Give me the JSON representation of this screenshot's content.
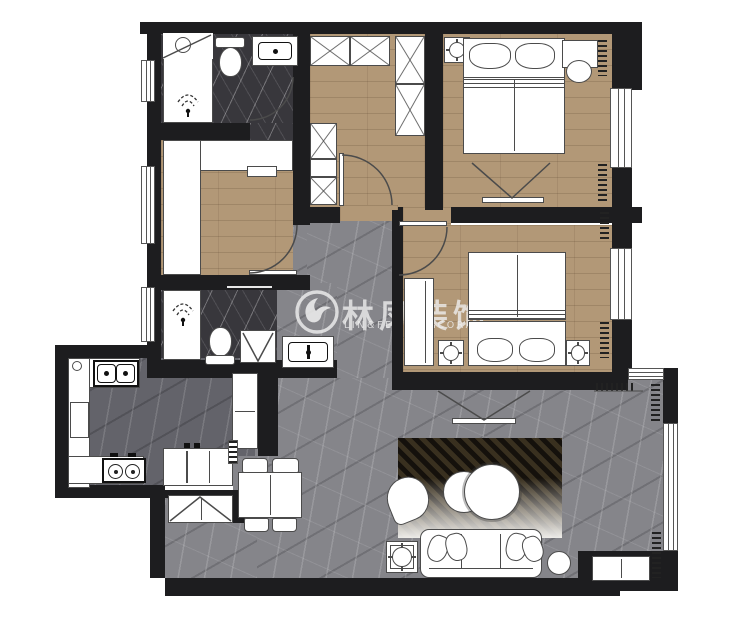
{
  "watermark": {
    "title": "林凤装饰",
    "subtitle": "LIN&FENG DECORATION",
    "logo": "phoenix-swirl-logo"
  },
  "palette": {
    "wall": "#1d1d1f",
    "wood_floor": "#b29877",
    "marble_gray": "#85858a",
    "marble_dark": "#38373c",
    "kitchen_floor": "#63636a",
    "furniture_line": "#4b4b4b",
    "watermark_color": "rgba(240,240,240,0.78)"
  },
  "rooms": [
    "bathroom-1",
    "walk-in-closet",
    "bedroom-1",
    "study",
    "bathroom-2",
    "bedroom-2",
    "kitchen",
    "dining",
    "hallway",
    "living-room",
    "balcony-bay"
  ],
  "furniture": [
    "shower",
    "toilet",
    "sink",
    "wardrobe-x-cabinets",
    "double-bed",
    "nightstand",
    "lamp",
    "tv-mount",
    "washing-machine",
    "kitchen-sink",
    "gas-stove",
    "fridge",
    "dining-table",
    "chairs",
    "shoe-cabinet",
    "rug",
    "armchair",
    "round-coffee-tables",
    "sofa",
    "floor-lamp",
    "side-table",
    "curtains",
    "windows"
  ]
}
